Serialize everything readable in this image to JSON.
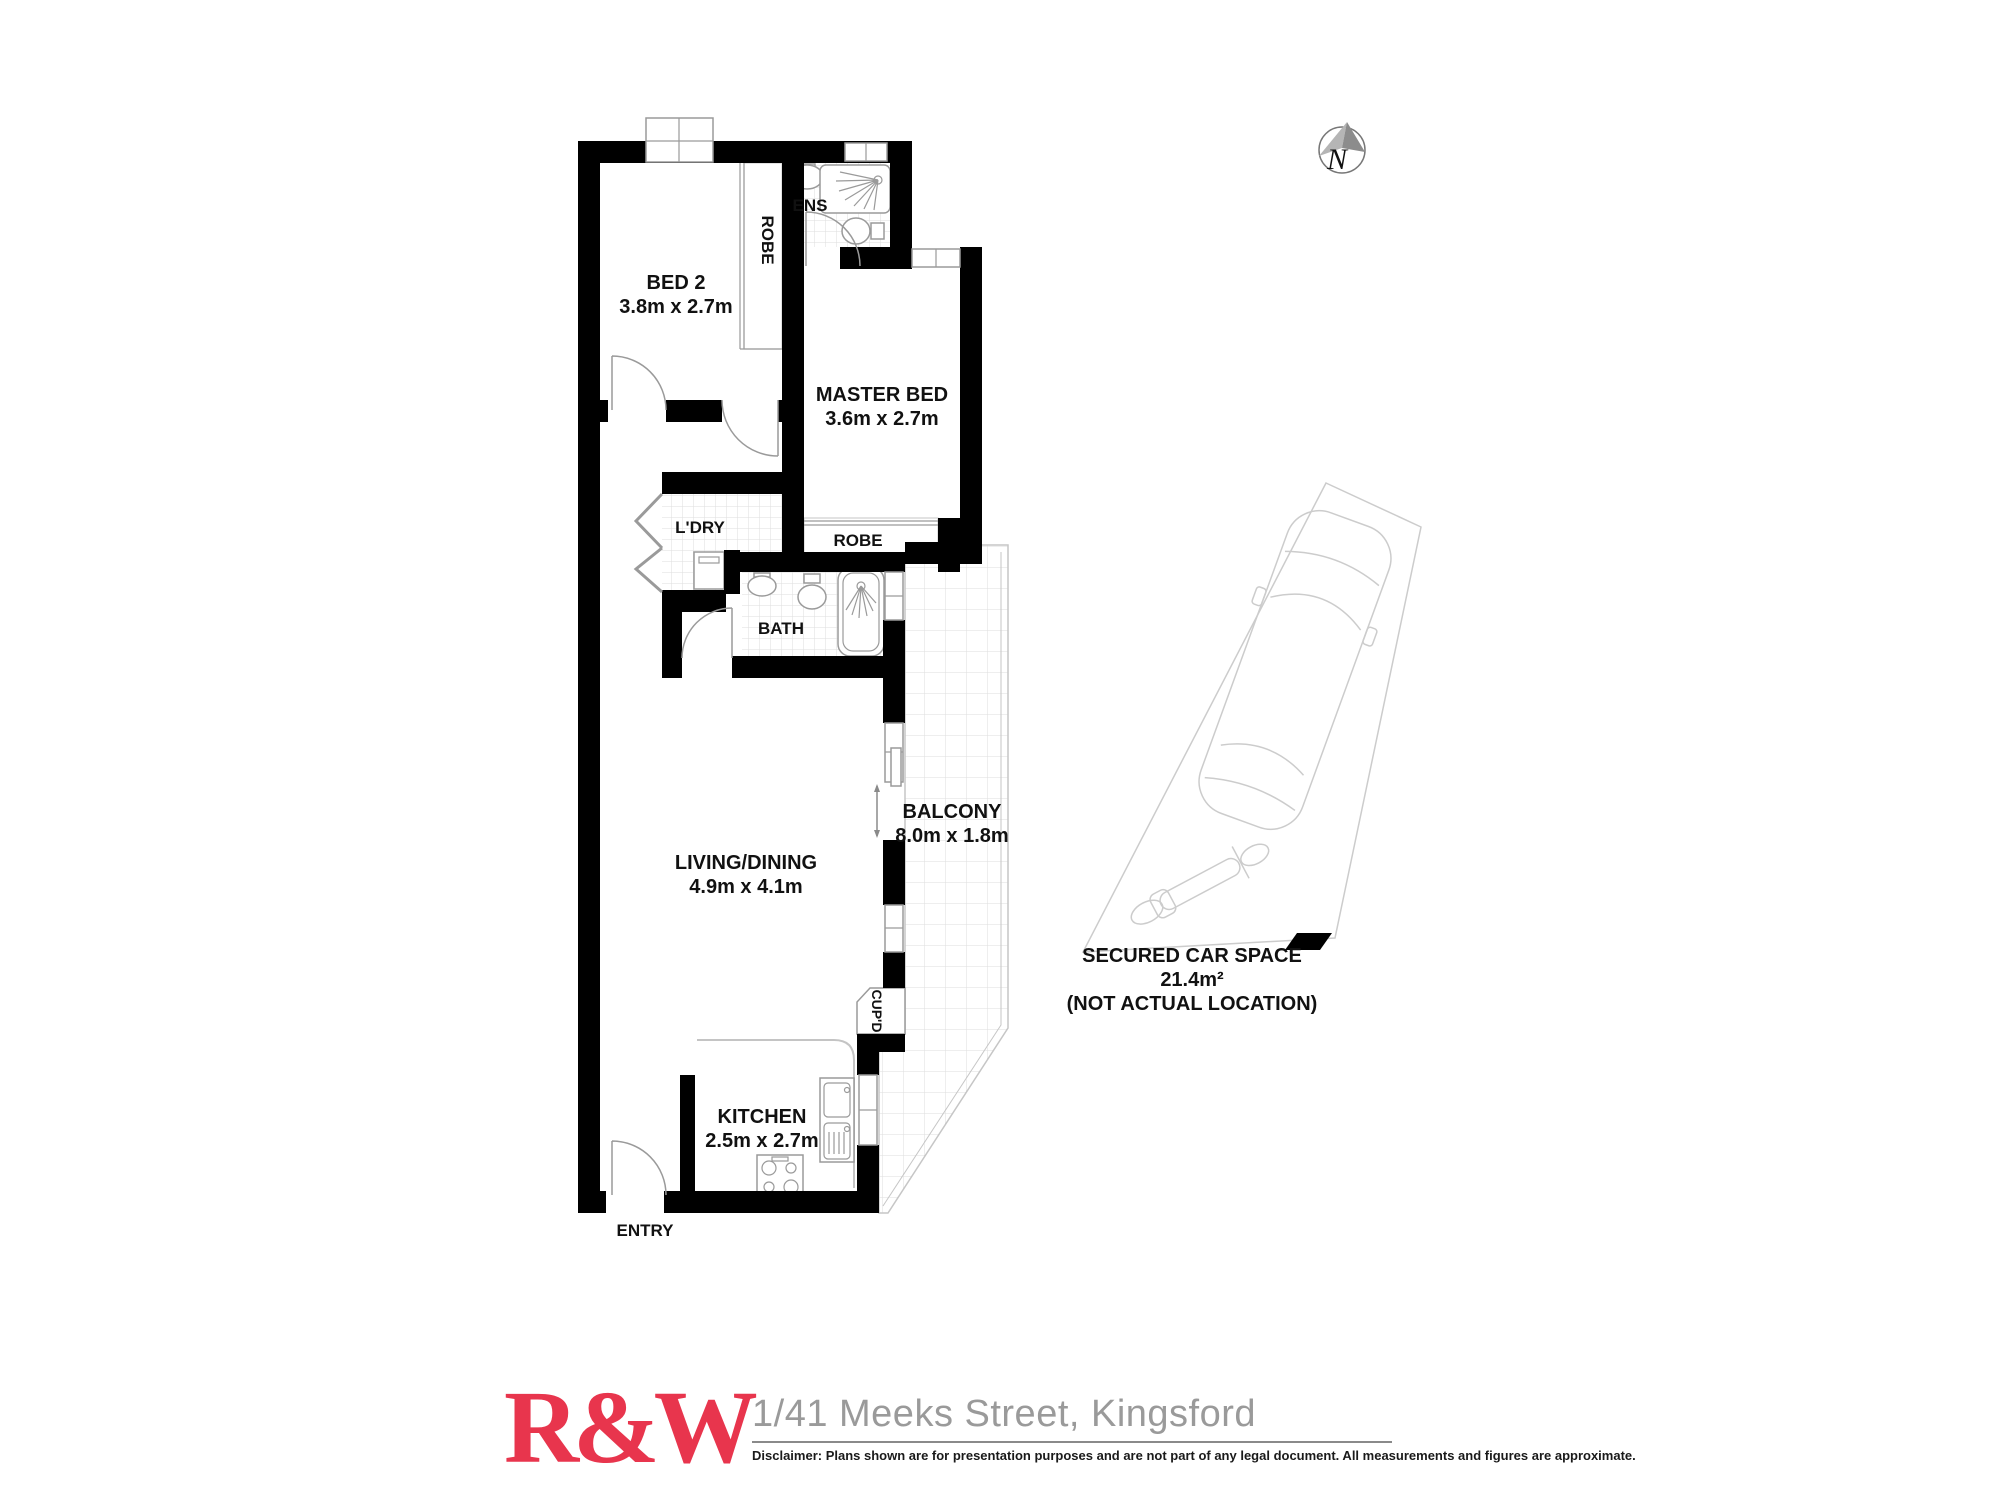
{
  "compass": {
    "north_label": "N"
  },
  "plan": {
    "rooms": {
      "bed2": {
        "name": "BED 2",
        "dims": "3.8m x 2.7m"
      },
      "bed2_robe": {
        "name": "ROBE"
      },
      "ens": {
        "name": "ENS"
      },
      "master": {
        "name": "MASTER BED",
        "dims": "3.6m x 2.7m"
      },
      "master_robe": {
        "name": "ROBE"
      },
      "ldry": {
        "name": "L'DRY"
      },
      "bath": {
        "name": "BATH"
      },
      "living": {
        "name": "LIVING/DINING",
        "dims": "4.9m x 4.1m"
      },
      "balcony": {
        "name": "BALCONY",
        "dims": "8.0m x 1.8m"
      },
      "cupd": {
        "name": "CUP'D"
      },
      "kitchen": {
        "name": "KITCHEN",
        "dims": "2.5m x 2.7m"
      },
      "entry": {
        "name": "ENTRY"
      }
    }
  },
  "car_space": {
    "title": "SECURED CAR SPACE",
    "area": "21.4m²",
    "note": "(NOT ACTUAL LOCATION)"
  },
  "footer": {
    "logo_text": "R&W",
    "address": "1/41 Meeks Street, Kingsford",
    "disclaimer": "Disclaimer: Plans shown are for presentation purposes and are not part of any legal document. All measurements and figures are approximate."
  },
  "colors": {
    "brand_red": "#e8354d",
    "wall_black": "#000000",
    "fixture_gray": "#9a9a9a",
    "tile_gray": "#dedede",
    "address_gray": "#9a9a9a"
  }
}
